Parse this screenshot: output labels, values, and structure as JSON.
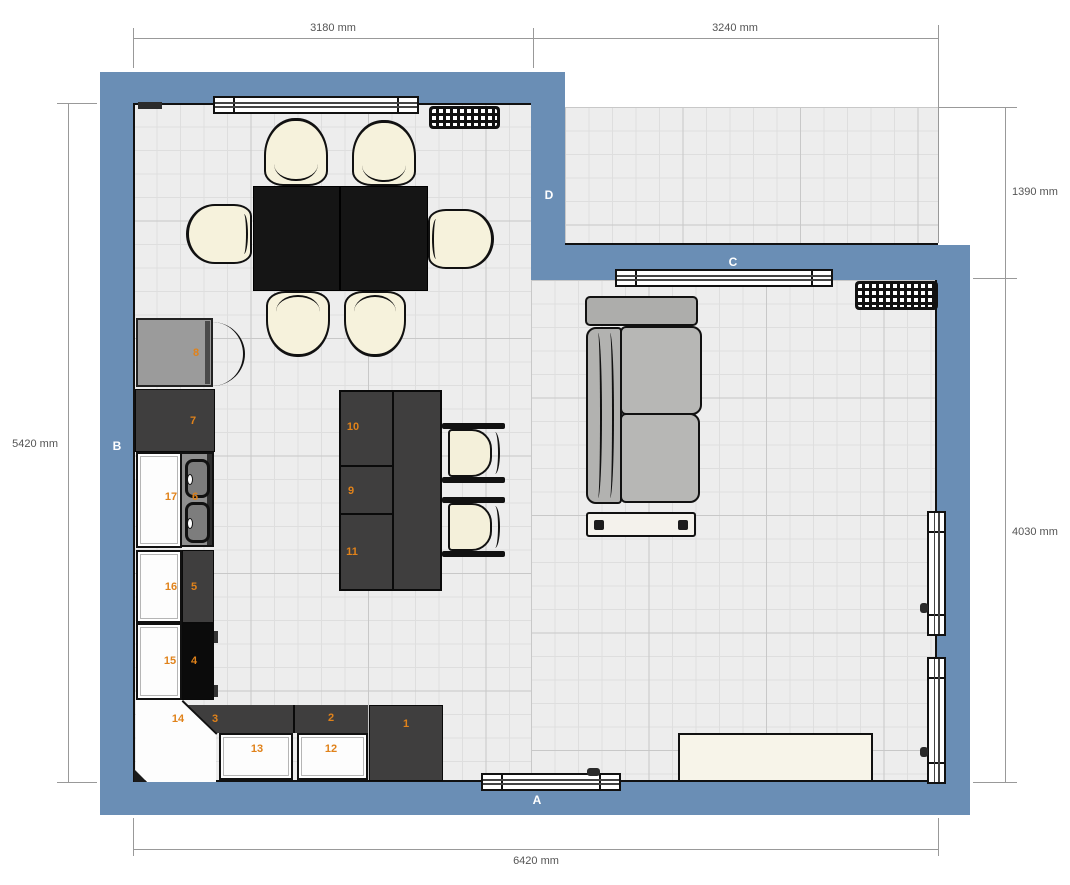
{
  "dimensions": {
    "top_left": "3180 mm",
    "top_right": "3240 mm",
    "right_upper": "1390 mm",
    "right_lower": "4030 mm",
    "left": "5420 mm",
    "bottom": "6420 mm"
  },
  "walls": {
    "a": "A",
    "b": "B",
    "c": "C",
    "d": "D"
  },
  "units": {
    "u1": "1",
    "u2": "2",
    "u3": "3",
    "u4": "4",
    "u5": "5",
    "u6": "6",
    "u7": "7",
    "u8": "8",
    "u9": "9",
    "u10": "10",
    "u11": "11",
    "u12": "12",
    "u13": "13",
    "u14": "14",
    "u15": "15",
    "u16": "16",
    "u17": "17"
  },
  "colors": {
    "wall": "#6a8eb5",
    "floor": "#ededed",
    "grid_minor": "#dedede",
    "grid_major": "#c8c8c8",
    "cabinet_dark": "#3f3e3e",
    "cabinet_white": "#fdfdfd",
    "unit_number": "#e0821a",
    "table": "#151515",
    "seat_cream": "#f6f2dc",
    "sofa": "#b4b4b2",
    "dimension_text": "#555555"
  }
}
